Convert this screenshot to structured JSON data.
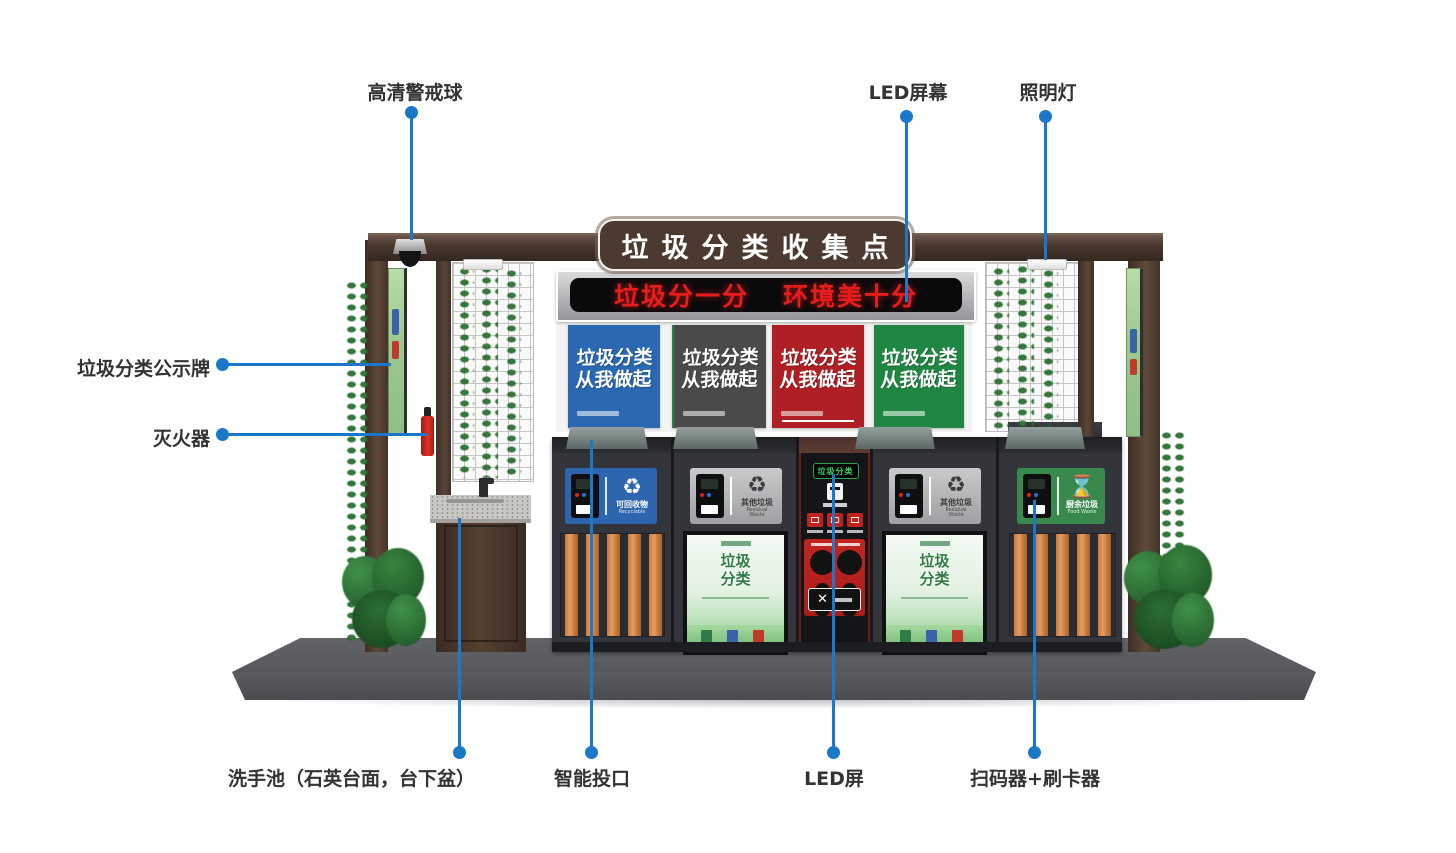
{
  "callouts": {
    "camera": "高清警戒球",
    "led_screen": "LED屏幕",
    "light": "照明灯",
    "notice_board": "垃圾分类公示牌",
    "extinguisher": "灭火器",
    "sink": "洗手池（石英台面，台下盆）",
    "smart_inlet": "智能投口",
    "led_small": "LED屏",
    "scanner": "扫码器+刷卡器"
  },
  "sign": {
    "title": "垃圾分类收集点"
  },
  "led_banner": {
    "left": "垃圾分一分",
    "right": "环境美十分",
    "text_color": "#e81c1c",
    "frame_color": "#b9babd"
  },
  "posters": {
    "slogan_line1": "垃圾分类",
    "slogan_line2": "从我做起",
    "colors": [
      "#2a69b2",
      "#4b4949",
      "#b01f24",
      "#1f8742"
    ]
  },
  "bins": {
    "sections": [
      {
        "label": "可回收物",
        "label_en": "Recyclable",
        "color": "#2d65ae"
      },
      {
        "label": "其他垃圾",
        "label_en": "Residual Waste",
        "color": "#b9babc"
      },
      {
        "label": "其他垃圾",
        "label_en": "Residual Waste",
        "color": "#b9babc"
      },
      {
        "label": "厨余垃圾",
        "label_en": "Food Waste",
        "color": "#38894b"
      }
    ],
    "center_led": "垃圾分类",
    "mini_poster": {
      "line1": "垃圾",
      "line2": "分类"
    }
  },
  "accent": {
    "callout_blue": "#1b78c9",
    "wood_brown": "#4a382e",
    "slat_orange": "#d2824a"
  }
}
